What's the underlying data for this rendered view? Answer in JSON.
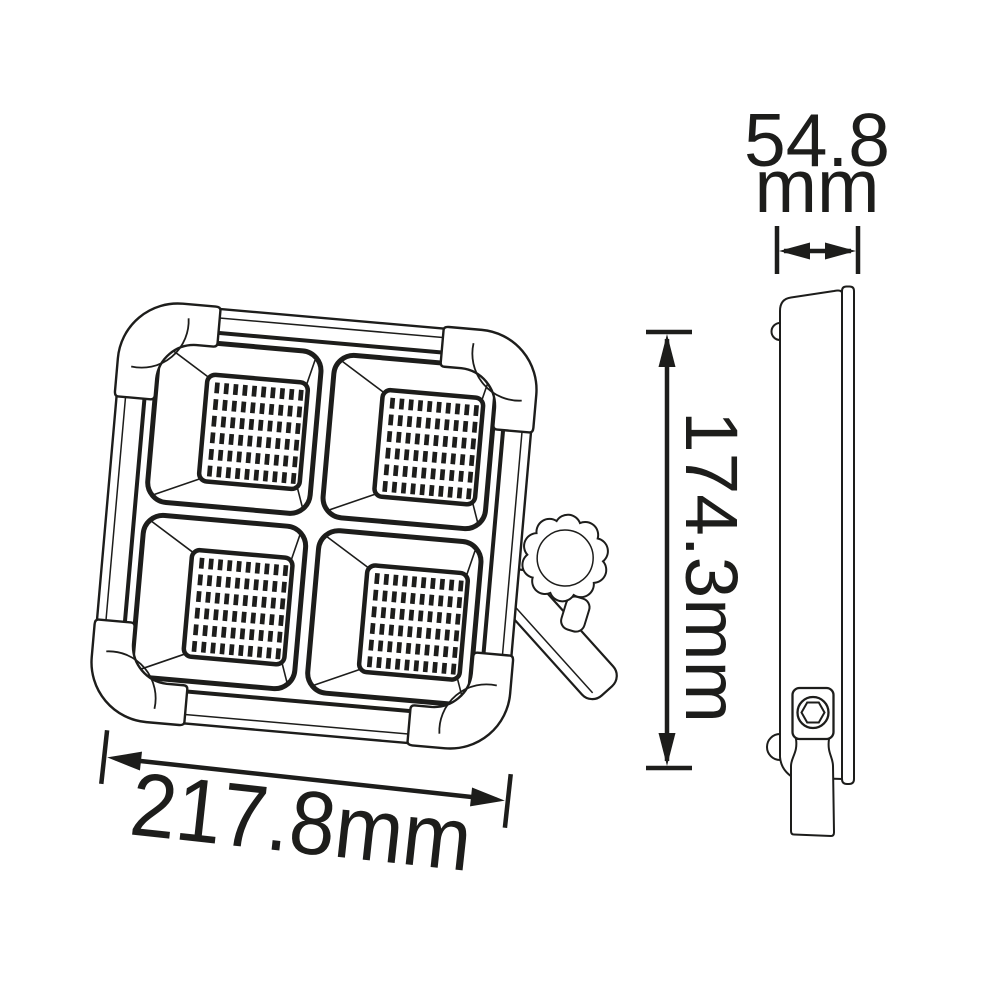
{
  "drawing": {
    "line_color": "#1d1d1b",
    "background": "#ffffff",
    "views": {
      "front": {
        "name": "front-view",
        "led_panels": 4,
        "led_grid": {
          "rows": 6,
          "cols": 10
        }
      },
      "side": {
        "name": "side-view"
      }
    },
    "dimensions": {
      "width": {
        "label": "217.8mm"
      },
      "height": {
        "label": "174.3mm"
      },
      "depth": {
        "value": "54.8",
        "unit": "mm"
      }
    }
  }
}
